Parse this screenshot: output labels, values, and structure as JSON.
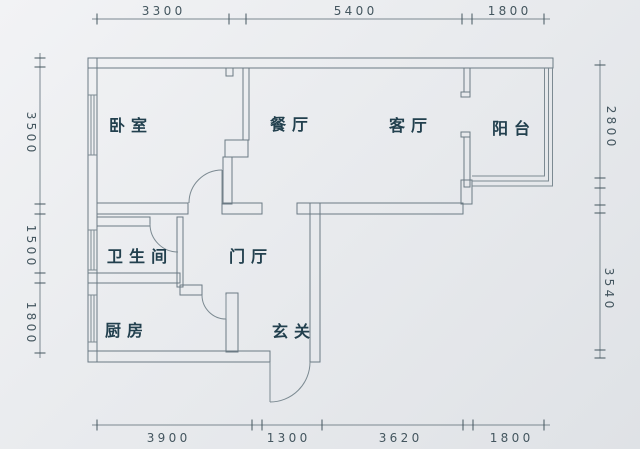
{
  "rooms": [
    {
      "id": "bedroom",
      "label": "卧室"
    },
    {
      "id": "dining",
      "label": "餐厅"
    },
    {
      "id": "living",
      "label": "客厅"
    },
    {
      "id": "balcony",
      "label": "阳台"
    },
    {
      "id": "bathroom",
      "label": "卫生间"
    },
    {
      "id": "hall",
      "label": "门厅"
    },
    {
      "id": "kitchen",
      "label": "厨房"
    },
    {
      "id": "entry",
      "label": "玄关"
    }
  ],
  "dimensions": {
    "top": [
      {
        "value": "3300"
      },
      {
        "value": "5400"
      },
      {
        "value": "1800"
      }
    ],
    "bottom": [
      {
        "value": "3900"
      },
      {
        "value": "1300"
      },
      {
        "value": "3620"
      },
      {
        "value": "1800"
      }
    ],
    "left": [
      {
        "value": "3500"
      },
      {
        "value": "1500"
      },
      {
        "value": "1800"
      }
    ],
    "right": [
      {
        "value": "2800"
      },
      {
        "value": "3540"
      }
    ]
  },
  "colors": {
    "background": "#e9ebee",
    "background_edge": "#dfe2e6",
    "wall_line": "#6b7a84",
    "glazing_line": "#7c8a92",
    "room_text": "#22404e",
    "dim_text": "#44565f",
    "dim_line": "#7b8890"
  }
}
